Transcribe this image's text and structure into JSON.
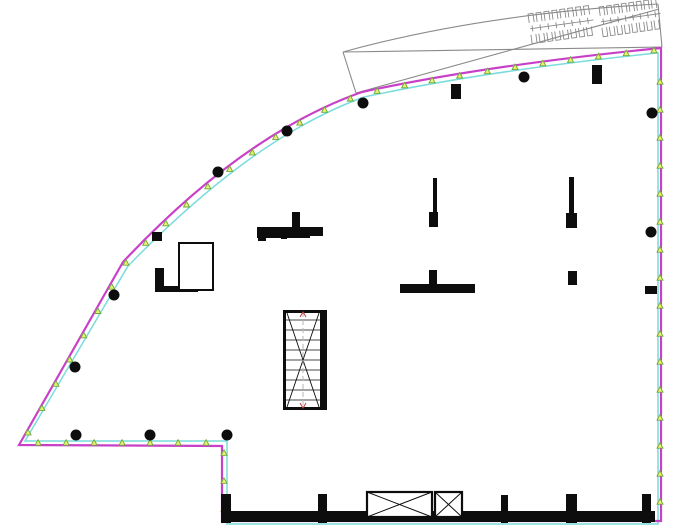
{
  "canvas": {
    "width": 680,
    "height": 530,
    "background": "#ffffff"
  },
  "colors": {
    "outline_magenta": "#c840c8",
    "slab_cyan": "#7adcdc",
    "marker_yellow": "#eef070",
    "marker_green": "#6aa83c",
    "wall_black": "#0d0d0d",
    "canopy_gray": "#8a8a8a",
    "tread_gray": "#4a4a4a",
    "centerline_gray": "#b5b5b5",
    "tick_red": "#c43a3a"
  },
  "boundary": {
    "outer_path": "M 661,48 C 550,59 450,73 362,92 C 280,121 200,180 123,262 L 19,445 L 222,446 L 222,521 L 661,521 Z",
    "inner_path": "M 657,53 C 551,64 453,78 364,97 C 284,126 207,185 128,266 L 25,441 L 227,441 L 227,524 L 658,524 L 658,53 Z",
    "marker_paths": [
      "M 660,50 C 551,61 452,75 363,94 C 282,123 204,182 125,264 L 22,443 L 224,443 L 224,519",
      "M 660,76 L 660,518"
    ],
    "marker_spacing": 28
  },
  "canopy": {
    "lines": [
      "M 343,52 L 356,93",
      "M 343,52 Q 480,14 658,4",
      "M 658,4 L 662,47",
      "M 343,52 L 662,47",
      "M 356,93 L 659,9"
    ],
    "clusters": [
      {
        "x": 528,
        "y": 14,
        "width": 64,
        "height": 30,
        "rotation": -8,
        "teeth": 8
      },
      {
        "x": 599,
        "y": 7,
        "width": 60,
        "height": 30,
        "rotation": -8,
        "teeth": 8
      }
    ]
  },
  "round_columns": [
    [
      524,
      77
    ],
    [
      363,
      103
    ],
    [
      287,
      131
    ],
    [
      218,
      172
    ],
    [
      114,
      295
    ],
    [
      75,
      367
    ],
    [
      76,
      435
    ],
    [
      150,
      435
    ],
    [
      227,
      435
    ],
    [
      652,
      113
    ],
    [
      651,
      232
    ]
  ],
  "rect_columns": [
    [
      451,
      84,
      10,
      15
    ],
    [
      592,
      65,
      10,
      19
    ],
    [
      152,
      232,
      10,
      9
    ],
    [
      429,
      212,
      9,
      15
    ],
    [
      566,
      213,
      11,
      15
    ],
    [
      568,
      271,
      9,
      14
    ],
    [
      645,
      286,
      12,
      8
    ],
    [
      221,
      494,
      10,
      29
    ],
    [
      318,
      494,
      9,
      29
    ],
    [
      501,
      495,
      7,
      28
    ],
    [
      566,
      494,
      11,
      29
    ],
    [
      642,
      494,
      9,
      29
    ]
  ],
  "walls": [
    [
      433,
      178,
      4,
      34
    ],
    [
      569,
      177,
      5,
      36
    ],
    [
      155,
      268,
      9,
      24
    ],
    [
      155,
      286,
      43,
      6
    ],
    [
      221,
      511,
      434,
      11
    ]
  ],
  "tees": [
    {
      "bar": [
        257,
        227,
        66,
        9
      ],
      "stem": [
        292,
        212,
        8,
        16
      ],
      "subline": [
        257,
        236,
        53,
        2
      ],
      "squares": [
        [
          258,
          233,
          8,
          8
        ],
        [
          281,
          233,
          6,
          6
        ]
      ]
    },
    {
      "bar": [
        400,
        284,
        75,
        9
      ],
      "stem": [
        429,
        270,
        8,
        15
      ],
      "subline": null,
      "squares": []
    }
  ],
  "outline_room": [
    179,
    243,
    34,
    47
  ],
  "stair": {
    "x": 283,
    "y": 310,
    "w": 44,
    "h": 100,
    "left_wall": 3,
    "right_wall": 7,
    "cap": 3,
    "treads": 9
  },
  "shafts": [
    [
      367,
      492,
      65,
      25
    ],
    [
      435,
      492,
      27,
      25
    ]
  ]
}
